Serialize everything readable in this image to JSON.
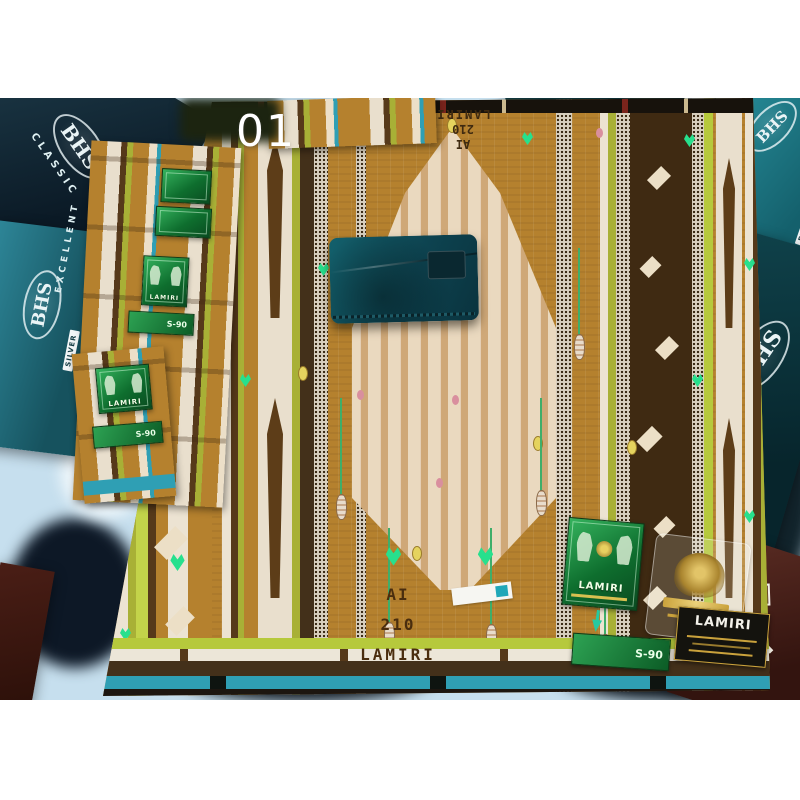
{
  "photo": {
    "watermark": "01",
    "bhs_boxes": {
      "brand": "BHS",
      "classic": "CLASSIC",
      "excellent": "EXCELLENT",
      "silver": "SILVER",
      "badge_10": "10",
      "partial_in": "IN"
    },
    "sarong": {
      "brand": "LAMIRI",
      "woven_lines": [
        "AI",
        "210",
        "LAMIRI"
      ]
    },
    "labels": {
      "lamiri": "LAMIRI",
      "size": "S-90"
    },
    "colors": {
      "sarong_base": "#b5812e",
      "center_cream": "#ead9bf",
      "lime": "#b6c93c",
      "dark_brown": "#43301a",
      "teal_stripe": "#2f9fb4",
      "background_blue": "#c6dfee",
      "box_teal": "#1f7f8c",
      "box_dark": "#0d3038",
      "label_green": "#1f9447",
      "gold": "#c9a43e",
      "pouch_teal": "#0e4752"
    }
  }
}
